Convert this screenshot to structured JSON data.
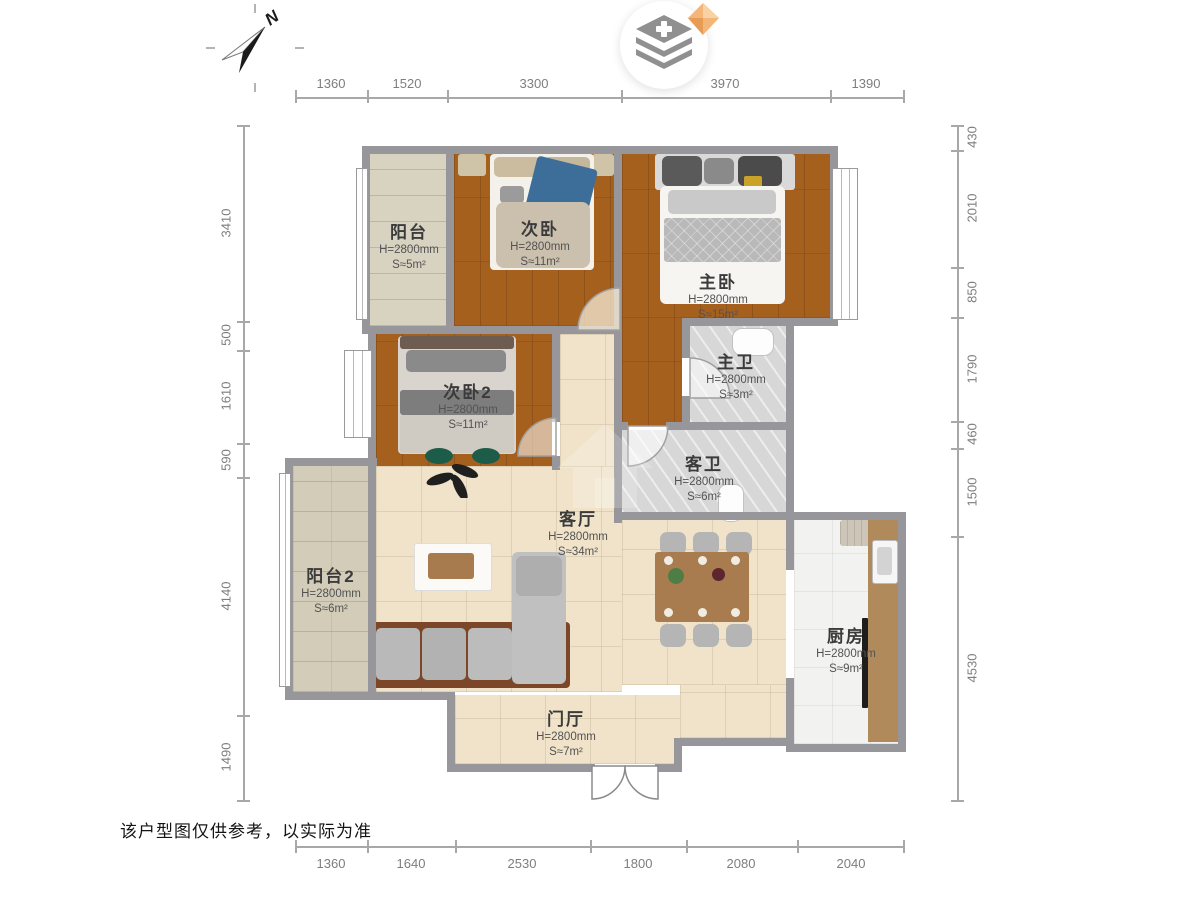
{
  "compass": {
    "label": "N"
  },
  "logo": {
    "icon": "layers-plus",
    "badge": "gem"
  },
  "disclaimer": "该户型图仅供参考，以实际为准",
  "rooms": [
    {
      "id": "balcony1",
      "name": "阳台",
      "height": "H=2800mm",
      "area": "S≈5m²"
    },
    {
      "id": "bedroom2",
      "name": "次卧",
      "height": "H=2800mm",
      "area": "S≈11m²"
    },
    {
      "id": "master",
      "name": "主卧",
      "height": "H=2800mm",
      "area": "S≈15m²"
    },
    {
      "id": "masterbath",
      "name": "主卫",
      "height": "H=2800mm",
      "area": "S≈3m²"
    },
    {
      "id": "bedroom3",
      "name": "次卧2",
      "height": "H=2800mm",
      "area": "S≈11m²"
    },
    {
      "id": "guestbath",
      "name": "客卫",
      "height": "H=2800mm",
      "area": "S≈6m²"
    },
    {
      "id": "living",
      "name": "客厅",
      "height": "H=2800mm",
      "area": "S≈34m²"
    },
    {
      "id": "balcony2",
      "name": "阳台2",
      "height": "H=2800mm",
      "area": "S≈6m²"
    },
    {
      "id": "kitchen",
      "name": "厨房",
      "height": "H=2800mm",
      "area": "S≈9m²"
    },
    {
      "id": "foyer",
      "name": "门厅",
      "height": "H=2800mm",
      "area": "S≈7m²"
    }
  ],
  "dimensions": {
    "top": [
      "1360",
      "1520",
      "3300",
      "3970",
      "1390"
    ],
    "bottom": [
      "1360",
      "1640",
      "2530",
      "1800",
      "2080",
      "2040"
    ],
    "left": [
      "3410",
      "500",
      "1610",
      "590",
      "4140",
      "1490"
    ],
    "right": [
      "430",
      "2010",
      "850",
      "1790",
      "460",
      "1500",
      "4530"
    ]
  },
  "colors": {
    "wood_floor": "#a5601e",
    "beige_tile": "#f0e3c9",
    "balcony_tile": "#d8d2c0",
    "marble_tile": "#d7d7d7",
    "kitchen_tile": "#f2f2f0",
    "wall": "#97979b",
    "dimension_text": "#7e7e7e",
    "logo_gem": "#f3b578"
  }
}
